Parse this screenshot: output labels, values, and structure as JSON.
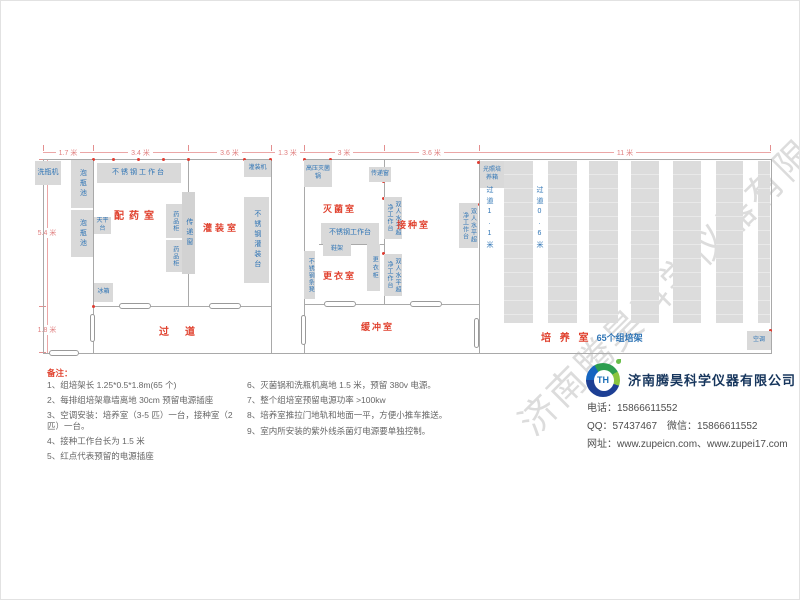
{
  "plan": {
    "dims_top": [
      "1.7 米",
      "3.4 米",
      "3.6 米",
      "1.3 米",
      "3 米",
      "3.6 米",
      "11 米"
    ],
    "dims_left": [
      "5.4 米",
      "1.8 米"
    ],
    "rooms": {
      "prep": "配药室",
      "filling": "灌装室",
      "steril": "灭菌室",
      "changing": "更衣室",
      "inocul": "接种室",
      "buffer": "缓冲室",
      "corridor": "过道",
      "culture": "培 养 室",
      "culture_sub": "65个组培架"
    },
    "equipment": {
      "wash_machine": "洗瓶机",
      "soak_pool": "泡瓶池",
      "worktable": "不锈钢工作台",
      "balance_table": "天平台",
      "fridge": "冰箱",
      "medicine_cabinet": "药品柜",
      "pass_window": "传递窗",
      "filling_machine": "灌装机",
      "filling_table": "不锈钢灌装台",
      "autoclave": "高压灭菌锅",
      "shoe_rack": "鞋架",
      "locker": "更衣柜",
      "steel_bench": "不锈钢条凳",
      "clean_bench": "双人水平超净工作台",
      "light_incubator": "光照培养箱",
      "air_conditioner": "空调",
      "aisle_wide": "过道1.1米",
      "aisle_narrow": "过道0.6米"
    }
  },
  "notes": {
    "title": "备注：",
    "left": [
      "1、组培架长 1.25*0.5*1.8m(65 个)",
      "2、每排组培架靠墙离地 30cm 预留电源插座",
      "3、空调安装：培养室（3-5 匹）一台，接种室（2 匹）一台。",
      "4、接种工作台长为 1.5 米",
      "5、红点代表预留的电源插座"
    ],
    "right": [
      "6、灭菌锅和洗瓶机离地 1.5 米，预留 380v 电源。",
      "7、整个组培室预留电源功率 >100kw",
      "8、培养室推拉门地轨和地面一平，方便小推车推送。",
      "9、室内所安装的紫外线杀菌灯电源要单独控制。"
    ]
  },
  "company": {
    "logo_text": "TH",
    "name": "济南腾昊科学仪器有限公司",
    "phone": "电话：15866611552",
    "qq_wechat": "QQ：57437467　微信：15866611552",
    "web": "网址：www.zupeicn.com、www.zupei17.com"
  },
  "watermark": "济南腾昊科学仪器有限公司",
  "colors": {
    "room_label": "#e0412e",
    "equipment_text": "#2e74b5",
    "dimension": "#e07f7f",
    "wall": "#a9a9a9",
    "equipment_bg": "#d9d9d9",
    "company_name": "#17365d"
  }
}
